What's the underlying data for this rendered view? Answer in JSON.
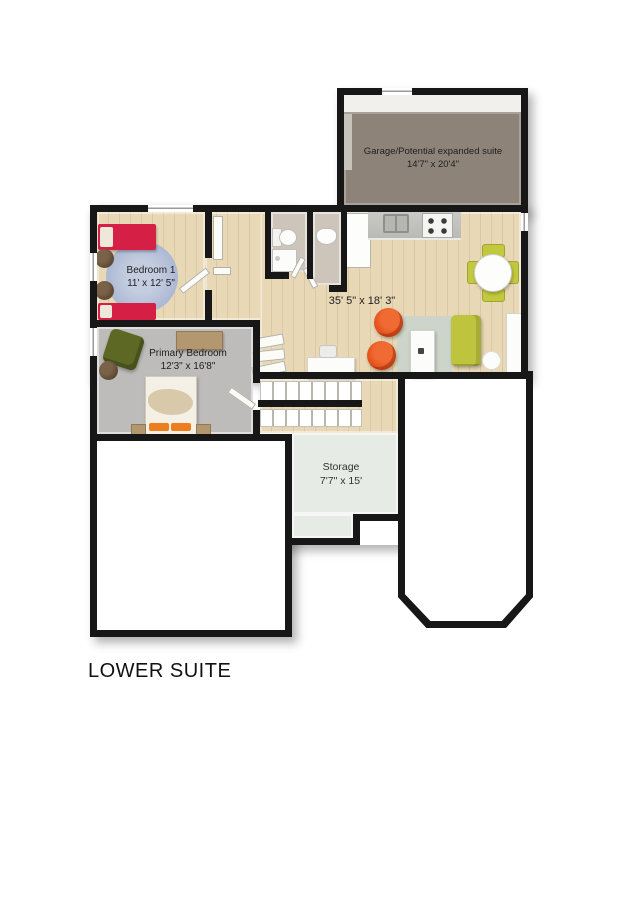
{
  "title": "LOWER SUITE",
  "rooms": {
    "garage": {
      "name": "Garage/Potential expanded suite",
      "dims": "14'7\" x 20'4\""
    },
    "bedroom1": {
      "name": "Bedroom 1",
      "dims": "11' x 12' 5\""
    },
    "primary_bedroom": {
      "name": "Primary Bedroom",
      "dims": "12'3\" x 16'8\""
    },
    "living_area": {
      "dims": "35' 5\" x 18' 3\""
    },
    "storage": {
      "name": "Storage",
      "dims": "7'7\" x 15'"
    }
  },
  "colors": {
    "wall": "#171717",
    "wood_floor": "#e9d8b6",
    "garage_floor": "#8d8379",
    "primary_floor": "#bebcba",
    "storage_floor": "#e6ebe6",
    "bed_red": "#d61f45",
    "chair_orange": "#e8481d",
    "sofa_green": "#c3c93f",
    "armchair_olive": "#5c6823",
    "rug_blue": "#a9b6d2"
  }
}
